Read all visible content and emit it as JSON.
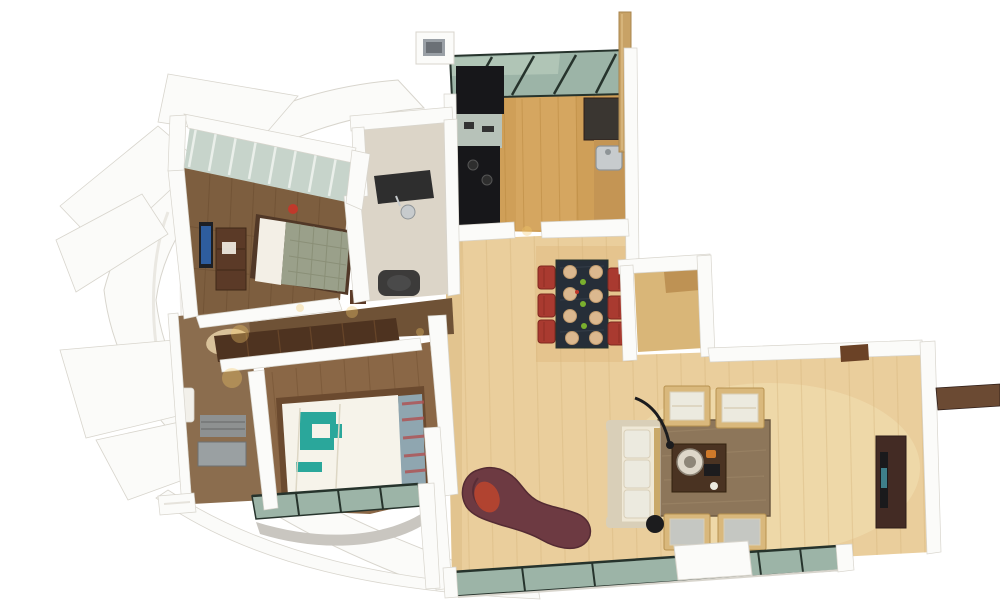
{
  "scene": {
    "type": "3d-floor-plan-render",
    "description": "Top-down 3D render of a two-bedroom apartment: curved white terrace fins on the left, master bedroom with louvered glass balcony top-left, kitchen with black cabinets and green skylight band at top, central dining table with red chairs, entrance foyer, living room with cream sofa, armchairs, rug and TV console at right, maroon chaise longue, teal-accent bed bottom-left, and green glazed balcony strips along the bottom.",
    "background": "#ffffff"
  },
  "rooms": [
    "master-bedroom",
    "master-balcony",
    "bathroom",
    "kitchen",
    "hallway",
    "second-bathroom",
    "bedroom-2",
    "dining-area",
    "entrance-foyer",
    "living-room",
    "south-balcony",
    "curved-terrace"
  ],
  "furniture": [
    "double-bed",
    "wall-tv",
    "dresser",
    "wardrobe",
    "kitchen-cabinets",
    "kitchen-sink",
    "dining-table",
    "dining-chairs",
    "sofa",
    "armchairs",
    "side-chairs",
    "coffee-table",
    "arc-floor-lamp",
    "area-rug",
    "tv-console",
    "chaise-longue",
    "teal-bed",
    "bath-shelves",
    "shower-tray"
  ],
  "counts": {
    "dining_chairs": 6,
    "place_settings": 8,
    "armchairs": 2,
    "side_chairs": 2,
    "sofa_cushions": 3,
    "beds": 2,
    "skylight_mullions": 4,
    "balcony_panels": 4
  },
  "colors": {
    "wall": "#fbfbf9",
    "wallEdge": "#d8d5cd",
    "wallShadow": "#e6e3dc",
    "apron": "#c9c6c0",
    "woodLight": "#eace9c",
    "woodLightStreak": "#d6b67e",
    "woodLightShade": "#dfb97f",
    "woodPale": "#f4e4b8",
    "woodKitchen": "#cf9f58",
    "woodKitchenStreak": "#b9883f",
    "woodKitchenPale": "#dcae67",
    "woodDark": "#7d5e3f",
    "woodDarkLine": "#66482d",
    "woodMid": "#8a6746",
    "woodMidLine": "#6f4e2f",
    "woodHall": "#6f5236",
    "woodBath": "#8b6d4e",
    "woodFoyer": "#d9b678",
    "matTan": "#b98c4e",
    "glass": "#9cb4a7",
    "glassSheen": "#c3d6c6",
    "glassFrame": "#26332c",
    "louver": "#c7d4cb",
    "louverStripe": "#eef2ee",
    "louverEdge": "#6a7a70",
    "cabinetBlack": "#17171a",
    "counterTeal": "#b7c2b9",
    "counterDark": "#3a3631",
    "counterWood": "#c49554",
    "steel": "#c7cbcd",
    "steelDark": "#8e9497",
    "redChair": "#a93a30",
    "redChairDark": "#7e281f",
    "tableDark": "#262e38",
    "tableLine": "#3a4450",
    "plate": "#dbb88f",
    "plateEdge": "#c09a6c",
    "garnish": "#7ab02e",
    "tomato": "#c0392b",
    "rug": "#8d765a",
    "rugDark": "#6e5a42",
    "rugSpeckle": "#a18a6b",
    "sofa": "#efe8d6",
    "sofaTrim": "#d9cfb8",
    "sofaWood": "#c9a96a",
    "cushionWhite": "#eceadf",
    "cushionGray": "#c5c7c2",
    "chairWood": "#d9b87c",
    "chairWoodEdge": "#b8924f",
    "coffee": "#4a3322",
    "coffeeEdge": "#32210f",
    "tray": "#ded7c9",
    "trayInner": "#8e8678",
    "orange": "#d07a2a",
    "lamp": "#1c1c1e",
    "tvUnit": "#432b24",
    "tvUnitEdge": "#2e1d18",
    "tvScreen": "#1a1a1c",
    "tvGlint": "#3e7f8a",
    "chaise": "#6d3a42",
    "chaiseDark": "#542b33",
    "chaiseAccent": "#b5432f",
    "bedFrame": "#513827",
    "pillowWhite": "#f3efe6",
    "duvetGray": "#9aa08a",
    "duvetLine": "#84896f",
    "redCushion": "#c0392b",
    "bed2Frame": "#6b4a2f",
    "duvetWhite": "#f6f3ea",
    "duvetFold": "#ddd7c5",
    "teal": "#2aa79b",
    "pillowBlue": "#8fa6b0",
    "pillowRed": "#b05050",
    "wardrobe": "#4e3320",
    "wardrobeLine": "#6e4a2c",
    "dresser": "#5b3a27",
    "dresserEdge": "#3f2817",
    "tvBlack": "#1d1f24",
    "tvScreenBlue": "#2e5d9e",
    "bathFloor": "#dcd5c8",
    "fixtureDark": "#2e2e2e",
    "fixtureMid": "#4a4a4a",
    "towel": "#d9c29a",
    "shelfGray": "#8e9191",
    "shelfLine": "#6e7171",
    "trayGray": "#9aa0a2",
    "pedestal": "#f2f0ea",
    "glow": "#f4c96a",
    "post": "#c8a266",
    "postEdge": "#a8854e",
    "postHi": "#e0c18a",
    "consoleBrown": "#6b4226",
    "neBar": "#6b4a33",
    "slotGray": "#9aa0a6",
    "slotDark": "#6b7076"
  }
}
